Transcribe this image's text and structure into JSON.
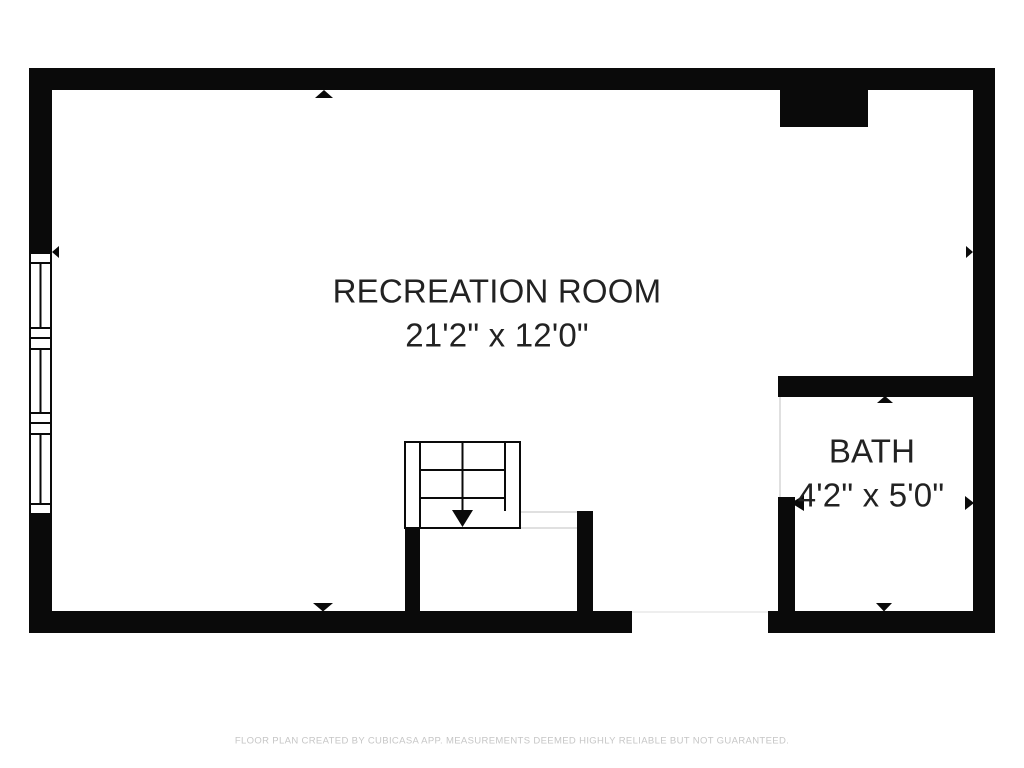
{
  "floor_plan": {
    "rooms": [
      {
        "id": "recreation_room",
        "name": "RECREATION ROOM",
        "dimensions": "21'2\" x 12'0\""
      },
      {
        "id": "bath",
        "name": "BATH",
        "dimensions": "4'2\" x 5'0\""
      }
    ],
    "footer": "FLOOR PLAN CREATED BY CUBICASA APP. MEASUREMENTS DEEMED HIGHLY RELIABLE BUT NOT GUARANTEED.",
    "colors": {
      "background": "#ffffff",
      "wall": "#0a0a0a",
      "room_text": "#222222",
      "faint_line": "#e0e0e0",
      "footer_text": "#c6c6c6"
    },
    "symbols": [
      "window-triple-left-wall",
      "staircase-down-arrow",
      "wall-niche-top-right",
      "dimension-arrows",
      "door-opening-bath",
      "door-opening-stair-closet"
    ]
  }
}
